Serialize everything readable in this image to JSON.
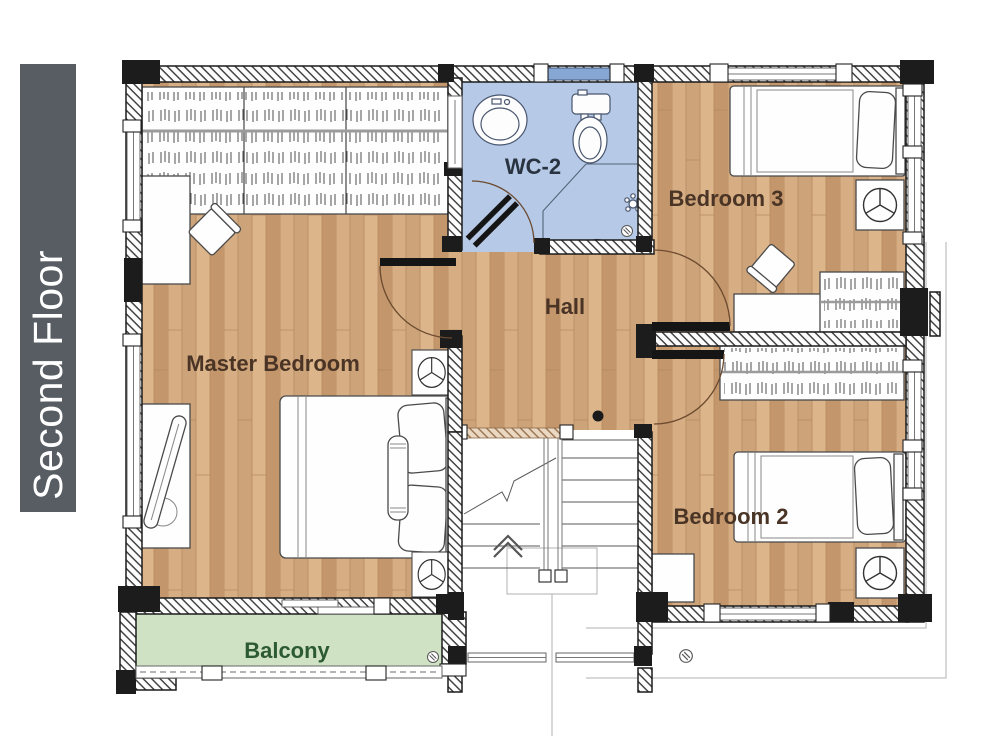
{
  "sidebar": {
    "floor_label": "Second Floor"
  },
  "rooms": {
    "master_bedroom": {
      "label": "Master Bedroom"
    },
    "wc2": {
      "label": "WC-2"
    },
    "hall": {
      "label": "Hall"
    },
    "bedroom3": {
      "label": "Bedroom 3"
    },
    "bedroom2": {
      "label": "Bedroom 2"
    },
    "balcony": {
      "label": "Balcony"
    }
  },
  "colors": {
    "sidebar_bg": "#575d63",
    "sidebar_text": "#ffffff",
    "wood_floor_light": "#d7ae84",
    "wood_floor_mid": "#cda47a",
    "wood_floor_dark": "#c3966c",
    "wc_floor": "#b6c9e6",
    "wc_window": "#86a6d3",
    "balcony_floor": "#d0e2c4",
    "wall_line": "#1c1c1c",
    "room_label": "#4a3425",
    "wc_label": "#2a3340",
    "balcony_label": "#2c5a33",
    "furniture_outline": "#4a4a4a"
  },
  "icons": {
    "ceiling_fan_icon": "circle with three blades",
    "floor_drain_icon": "hatched circle",
    "stairs_up_icon": "double chevron",
    "clothes_rail_icon": "hanger scribbles"
  }
}
